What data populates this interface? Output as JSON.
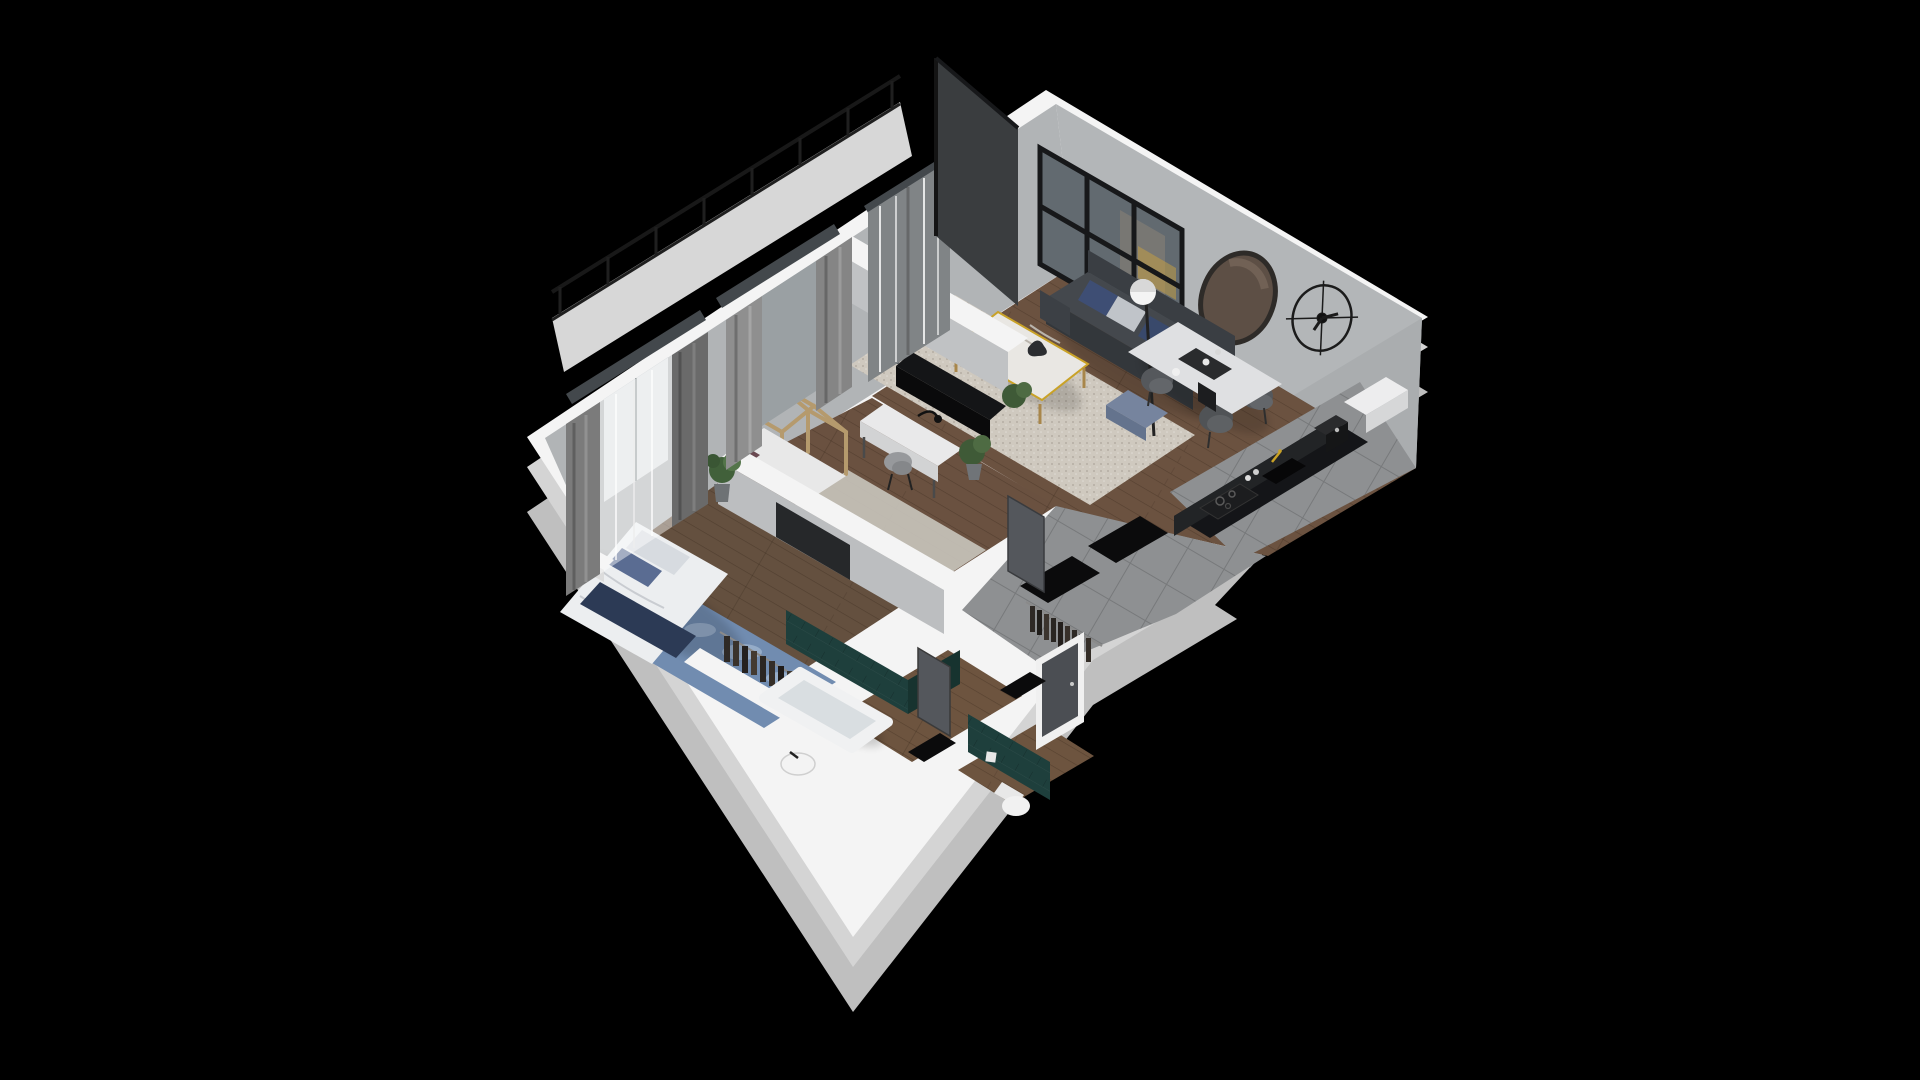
{
  "scene": {
    "type": "3d-isometric-floor-plan-render",
    "description": "Isometric cutaway 3D rendering of a furnished one-bedroom apartment with balcony, shown on a black background",
    "view": "bird's-eye three-quarter view, apartment rotated 45 degrees"
  },
  "colors": {
    "background": "#000000",
    "wall_top": "#f4f4f4",
    "wall_face": "#b3b6b8",
    "wall_face_nw": "#b1b4b6",
    "wall_face_se": "#aaadaf",
    "plinth": "#bfbfbf",
    "plinth_light": "#d4d4d4",
    "wood_floor": "#6b5240",
    "wood_floor_dark": "#64503f",
    "tile_floor": "#8e9092",
    "rug_cream": "#cfc9bf",
    "rug_blue": "#718cb0",
    "rug_gray": "#c9c5bd",
    "teal_tile": "#1e3f3c",
    "sofa": "#44484d",
    "bed_duvet": "#eceef0",
    "navy_throw": "#2c3a55",
    "marble": "#e9e7e3",
    "gold": "#c9a227",
    "feature_wall": "#3a3d3f",
    "door": "#54575c",
    "black_mat": "#0b0b0c",
    "glass": "#626a70",
    "railing": "#1f1f1f",
    "balcony_floor": "#d7d7d7",
    "kitchen_counter": "#141518"
  },
  "rooms": [
    {
      "name": "living-room",
      "floor": "wood",
      "furniture": [
        "sofa-with-pillows",
        "marble-coffee-table",
        "cream-rug",
        "blue-pouf",
        "floor-lamp",
        "tv-cabinet",
        "potted-plants",
        "glazed-black-frame-window",
        "round-wall-mirror",
        "wire-wall-clock"
      ]
    },
    {
      "name": "dining-area",
      "floor": "wood",
      "furniture": [
        "marble-dining-table",
        "four-upholstered-chairs",
        "serving-tray"
      ]
    },
    {
      "name": "kitchen",
      "floor": "gray-tile",
      "furniture": [
        "black-counter",
        "cooktop",
        "sink-with-gold-faucet",
        "coffee-machine",
        "white-cabinet"
      ]
    },
    {
      "name": "kids-room",
      "floor": "wood",
      "furniture": [
        "house-frame-bed",
        "white-desk",
        "desk-lamp",
        "chair",
        "potted-plant",
        "gray-rug",
        "window-with-curtains"
      ]
    },
    {
      "name": "bedroom",
      "floor": "wood",
      "furniture": [
        "double-bed",
        "navy-throw",
        "patterned-pillows",
        "blue-mottled-rug",
        "nightstand",
        "potted-plant",
        "recessed-tv",
        "open-clothes-rack",
        "window-with-sheer-and-curtains"
      ]
    },
    {
      "name": "bathroom",
      "wall_finish": "teal-tiles",
      "floor": "wood",
      "furniture": [
        "bathtub",
        "washbasin"
      ]
    },
    {
      "name": "wc",
      "wall_finish": "teal-tiles",
      "floor": "wood",
      "furniture": [
        "toilet",
        "flush-plate"
      ]
    },
    {
      "name": "hallway",
      "floor": "gray-tile",
      "furniture": [
        "open-wardrobe-with-clothes",
        "black-door-mats",
        "interior-doors",
        "entry-door"
      ]
    },
    {
      "name": "balcony",
      "furniture": [
        "glass-railing-with-posts"
      ]
    }
  ]
}
